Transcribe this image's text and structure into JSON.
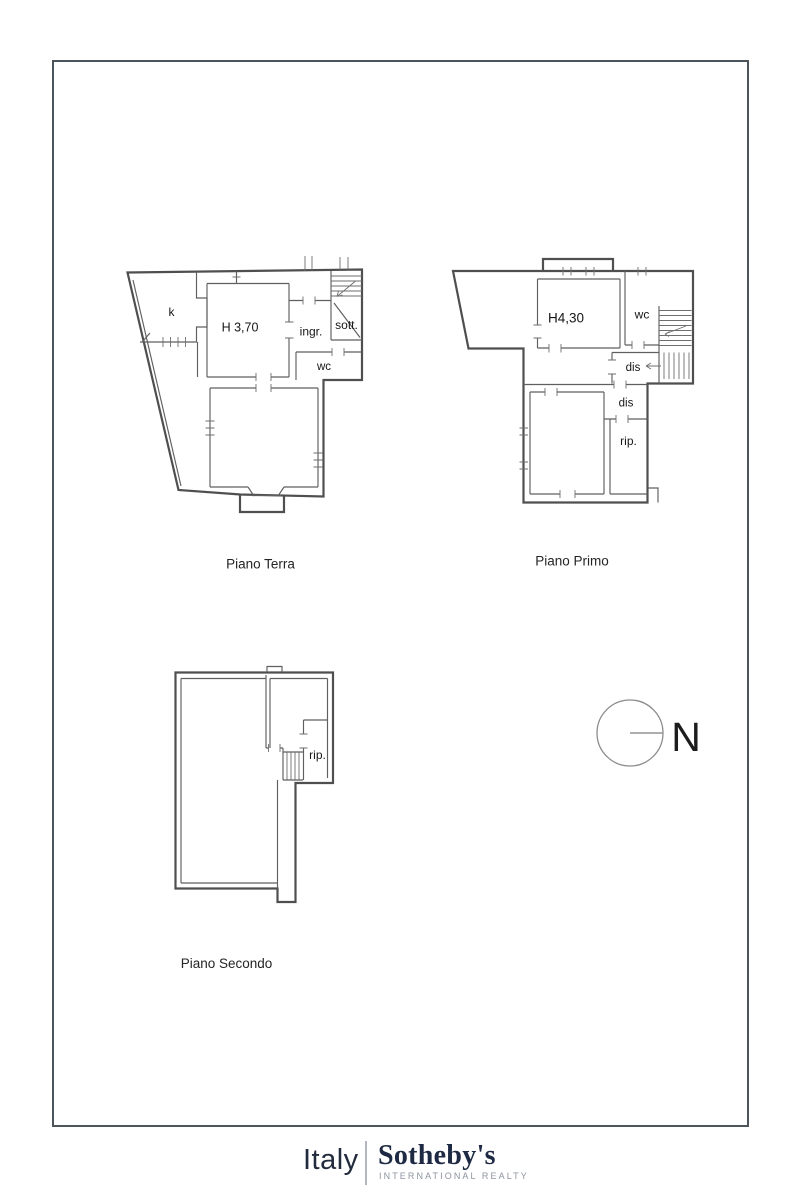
{
  "plans": {
    "piano_terra": {
      "caption": "Piano Terra",
      "labels": {
        "k": "k",
        "height": "H 3,70",
        "ingr": "ingr.",
        "sott": "sott.",
        "wc": "wc"
      }
    },
    "piano_primo": {
      "caption": "Piano Primo",
      "labels": {
        "height": "H4,30",
        "wc": "wc",
        "dis_upper": "dis",
        "dis_lower": "dis",
        "rip": "rip."
      }
    },
    "piano_secondo": {
      "caption": "Piano Secondo",
      "labels": {
        "rip": "rip."
      }
    }
  },
  "compass": {
    "north_label": "N"
  },
  "footer": {
    "region": "Italy",
    "brand": "Sotheby's",
    "tagline": "INTERNATIONAL REALTY"
  },
  "colors": {
    "plan_line": "#4f4f4f",
    "frame_border": "#4b555b",
    "brand_navy": "#1e2a44",
    "tagline_gray": "#8d939e",
    "page_background": "#ffffff"
  }
}
